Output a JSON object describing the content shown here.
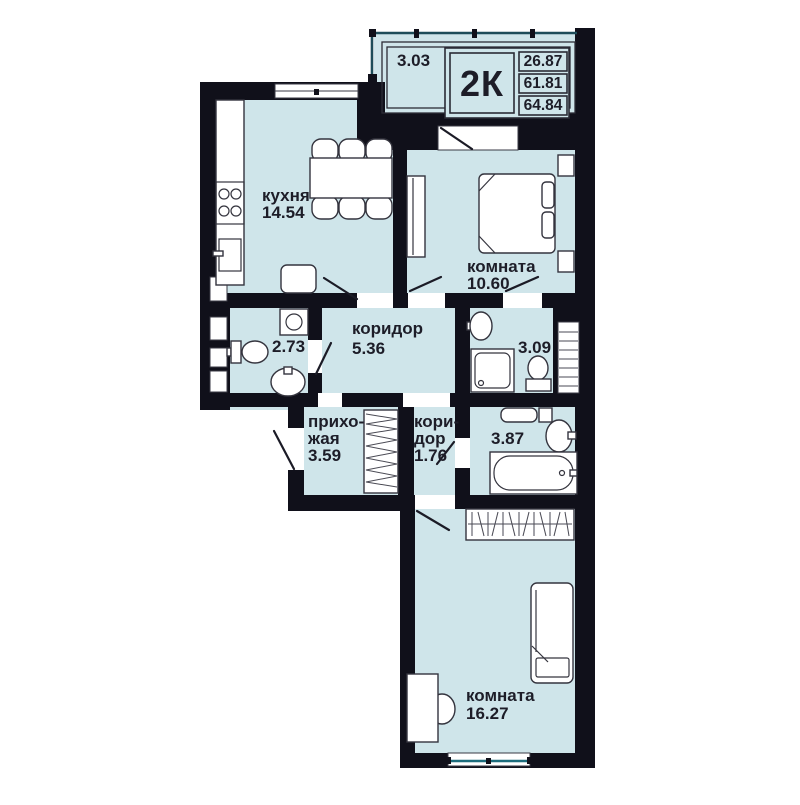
{
  "colors": {
    "floor": "#cfe5ea",
    "wall": "#10101a",
    "window_line": "#1d6d7d",
    "text": "#1d1d28"
  },
  "plan": {
    "unit_label": "2К",
    "area_rooms": "26.87",
    "area_living": "61.81",
    "area_total": "64.84",
    "balcony": {
      "area": "3.03"
    },
    "rooms": {
      "kitchen": {
        "name": "кухня",
        "area": "14.54"
      },
      "bedroom": {
        "name": "комната",
        "area": "10.60"
      },
      "corridor": {
        "name": "коридор",
        "area": "5.36"
      },
      "wc_guest": {
        "area": "2.73"
      },
      "shower_room": {
        "area": "3.09"
      },
      "hallway": {
        "name_l1": "прихо-",
        "name_l2": "жая",
        "area": "3.59"
      },
      "corridor_small": {
        "name_l1": "кори-",
        "name_l2": "дор",
        "area": "1.76"
      },
      "bathroom": {
        "area": "3.87"
      },
      "bedroom2": {
        "name": "комната",
        "area": "16.27"
      }
    }
  }
}
